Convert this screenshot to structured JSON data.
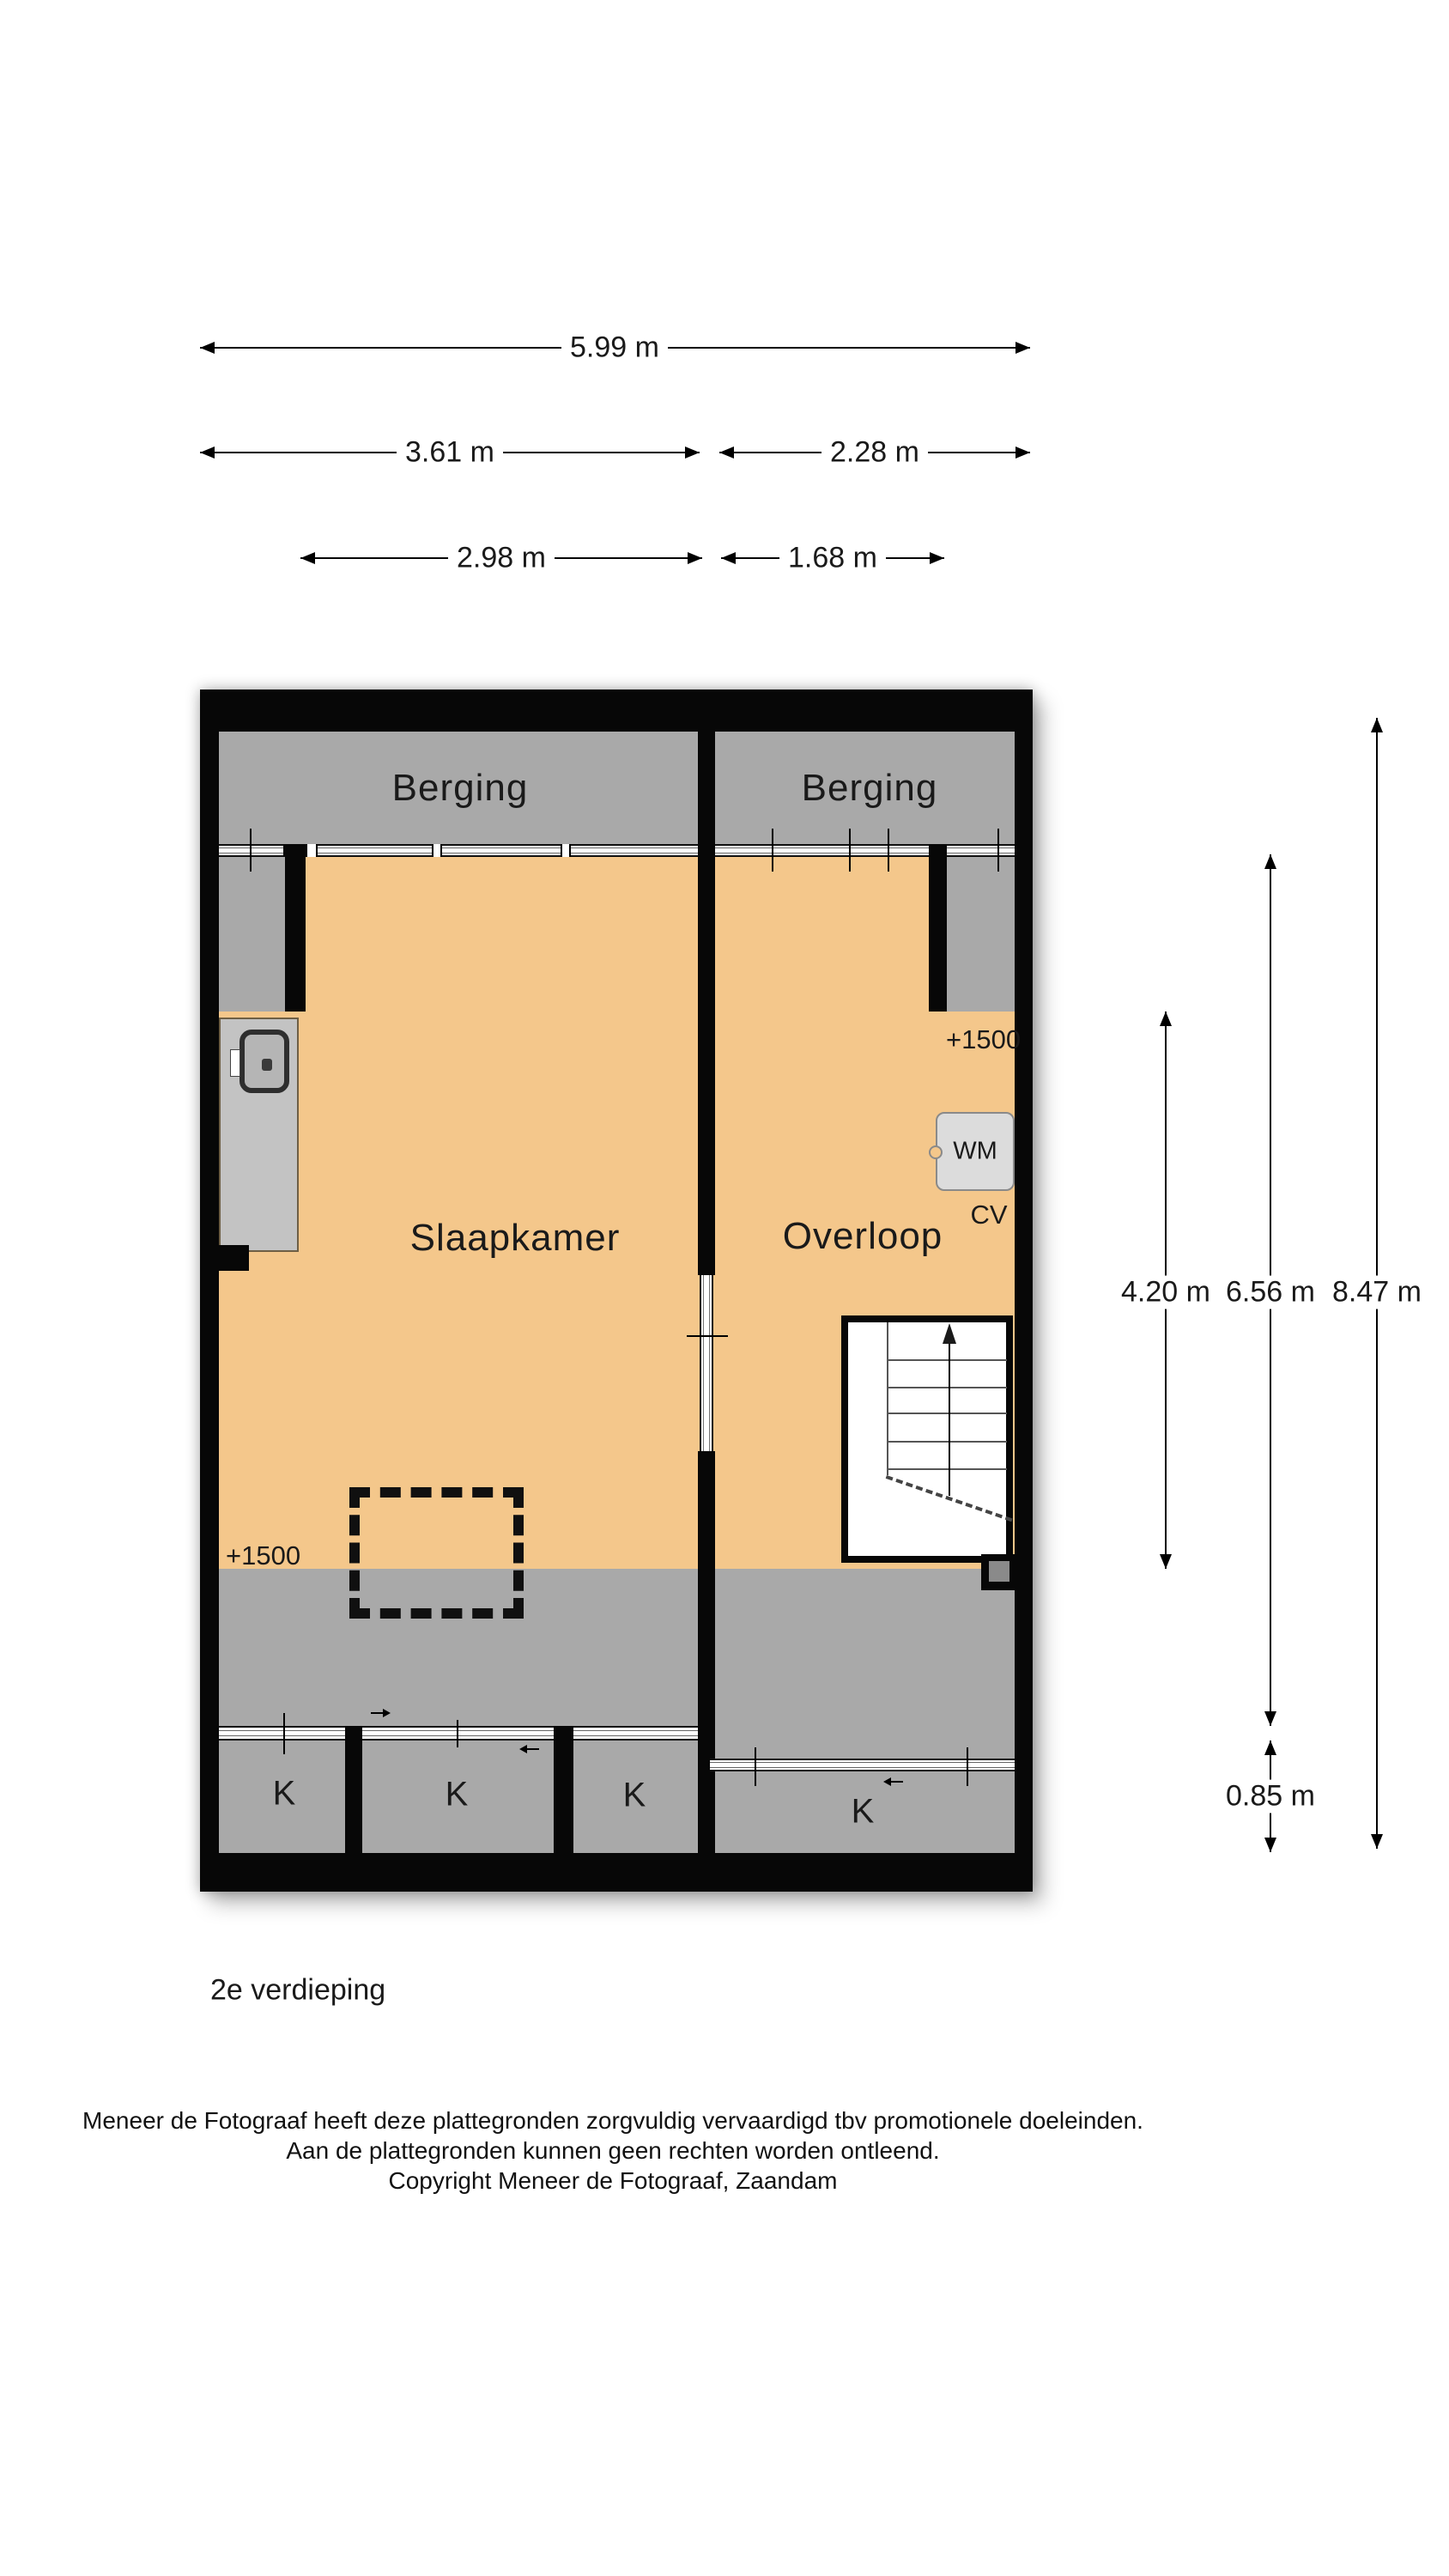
{
  "floorplan": {
    "rooms": {
      "berging_left": "Berging",
      "berging_right": "Berging",
      "slaapkamer": "Slaapkamer",
      "overloop": "Overloop"
    },
    "fixtures": {
      "washing_machine": "WM",
      "central_heating": "CV"
    },
    "height_markers": {
      "left": "+1500",
      "right": "+1500"
    },
    "koof_labels": [
      "K",
      "K",
      "K",
      "K"
    ]
  },
  "dimensions": {
    "top": [
      {
        "label": "5.99 m"
      },
      {
        "label": "3.61 m"
      },
      {
        "label": "2.28 m"
      },
      {
        "label": "2.98 m"
      },
      {
        "label": "1.68 m"
      }
    ],
    "right": [
      {
        "label": "4.20 m"
      },
      {
        "label": "6.56 m"
      },
      {
        "label": "8.47 m"
      },
      {
        "label": "0.85 m"
      }
    ]
  },
  "footer": {
    "floor_label": "2e verdieping",
    "disclaimer_line1": "Meneer de Fotograaf heeft deze plattegronden zorgvuldig vervaardigd tbv promotionele doeleinden.",
    "disclaimer_line2": "Aan de plattegronden kunnen geen rechten worden ontleend.",
    "disclaimer_line3": "Copyright Meneer de Fotograaf, Zaandam"
  },
  "colors": {
    "wall": "#070707",
    "floor_orange": "#f4c78b",
    "lowered_zone_gray": "#a9a9a9",
    "closet_panel_gray": "#c3c3c3",
    "appliance_gray": "#dcdcdc",
    "background": "#ffffff"
  }
}
